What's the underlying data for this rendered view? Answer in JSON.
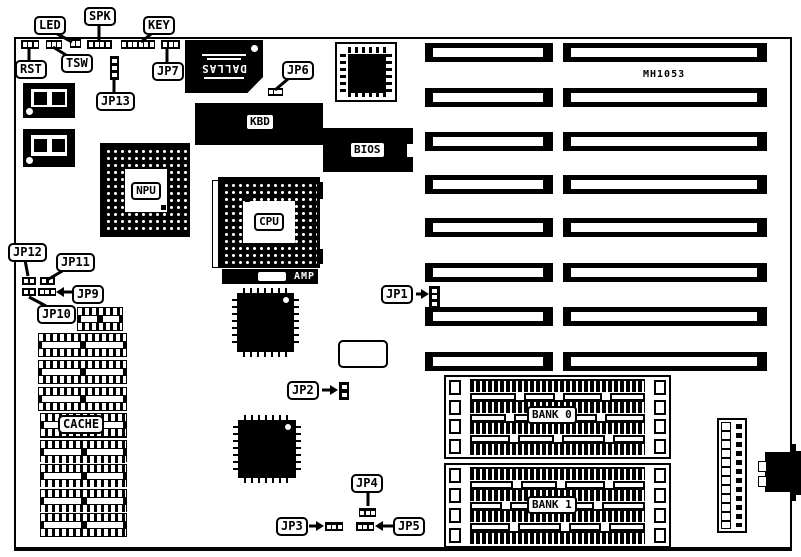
{
  "part_number": "MH1053",
  "colors": {
    "ink": "#000000",
    "paper": "#ffffff"
  },
  "callouts": {
    "led": "LED",
    "spk": "SPK",
    "key": "KEY",
    "rst": "RST",
    "tsw": "TSW",
    "jp1": "JP1",
    "jp2": "JP2",
    "jp3": "JP3",
    "jp4": "JP4",
    "jp5": "JP5",
    "jp6": "JP6",
    "jp7": "JP7",
    "jp9": "JP9",
    "jp10": "JP10",
    "jp11": "JP11",
    "jp12": "JP12",
    "jp13": "JP13"
  },
  "chips": {
    "dallas": "DALLAS",
    "kbd": "KBD",
    "bios": "BIOS",
    "npu": "NPU",
    "cpu": "CPU",
    "amp": "AMP",
    "cache": "CACHE"
  },
  "memory": {
    "bank0": "BANK 0",
    "bank1": "BANK 1"
  }
}
